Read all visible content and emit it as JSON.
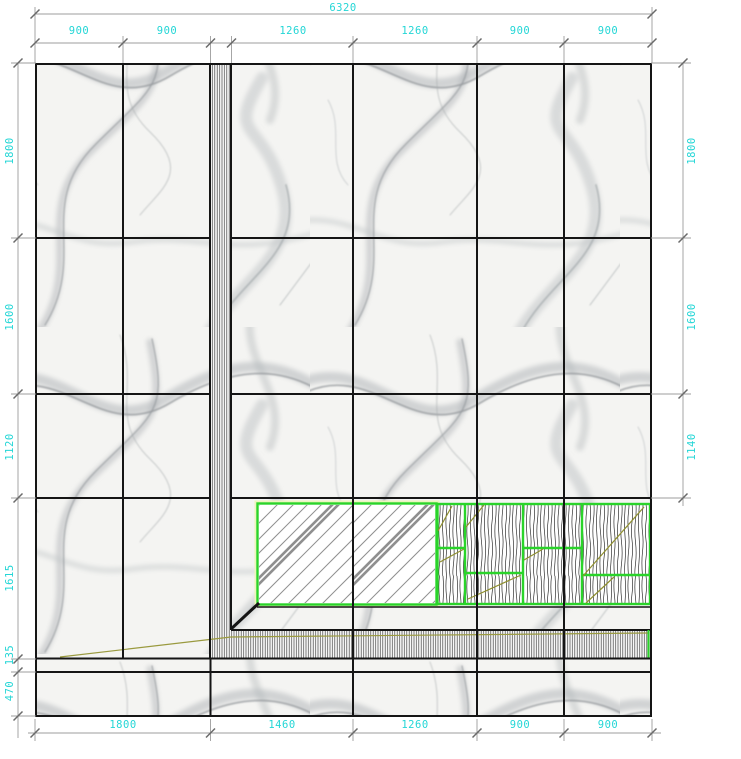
{
  "drawing": {
    "dims": {
      "top": {
        "overall": "6320",
        "segments": [
          "900",
          "900",
          "1260",
          "1260",
          "900",
          "900"
        ]
      },
      "left": [
        "1800",
        "1600",
        "1120",
        "1615",
        "135",
        "470"
      ],
      "right": [
        "1800",
        "1600",
        "1140"
      ],
      "bottom": [
        "1800",
        "1460",
        "1260",
        "900",
        "900"
      ]
    },
    "colors": {
      "dimension_text": "#24d6d6",
      "dimension_line": "#9c9c9c",
      "grid_line": "#151515",
      "panel_outline_green": "#2ad42a",
      "grain_accent_olive": "#8f8f2f",
      "marble_vein": "#a9adb0"
    },
    "materials": {
      "wall_field": "marble-slab",
      "trim_band": "vertical-hatch-strip",
      "inset_left": "glass-panel-diagonal-hatch",
      "inset_right": "wood-grain-panels"
    }
  }
}
